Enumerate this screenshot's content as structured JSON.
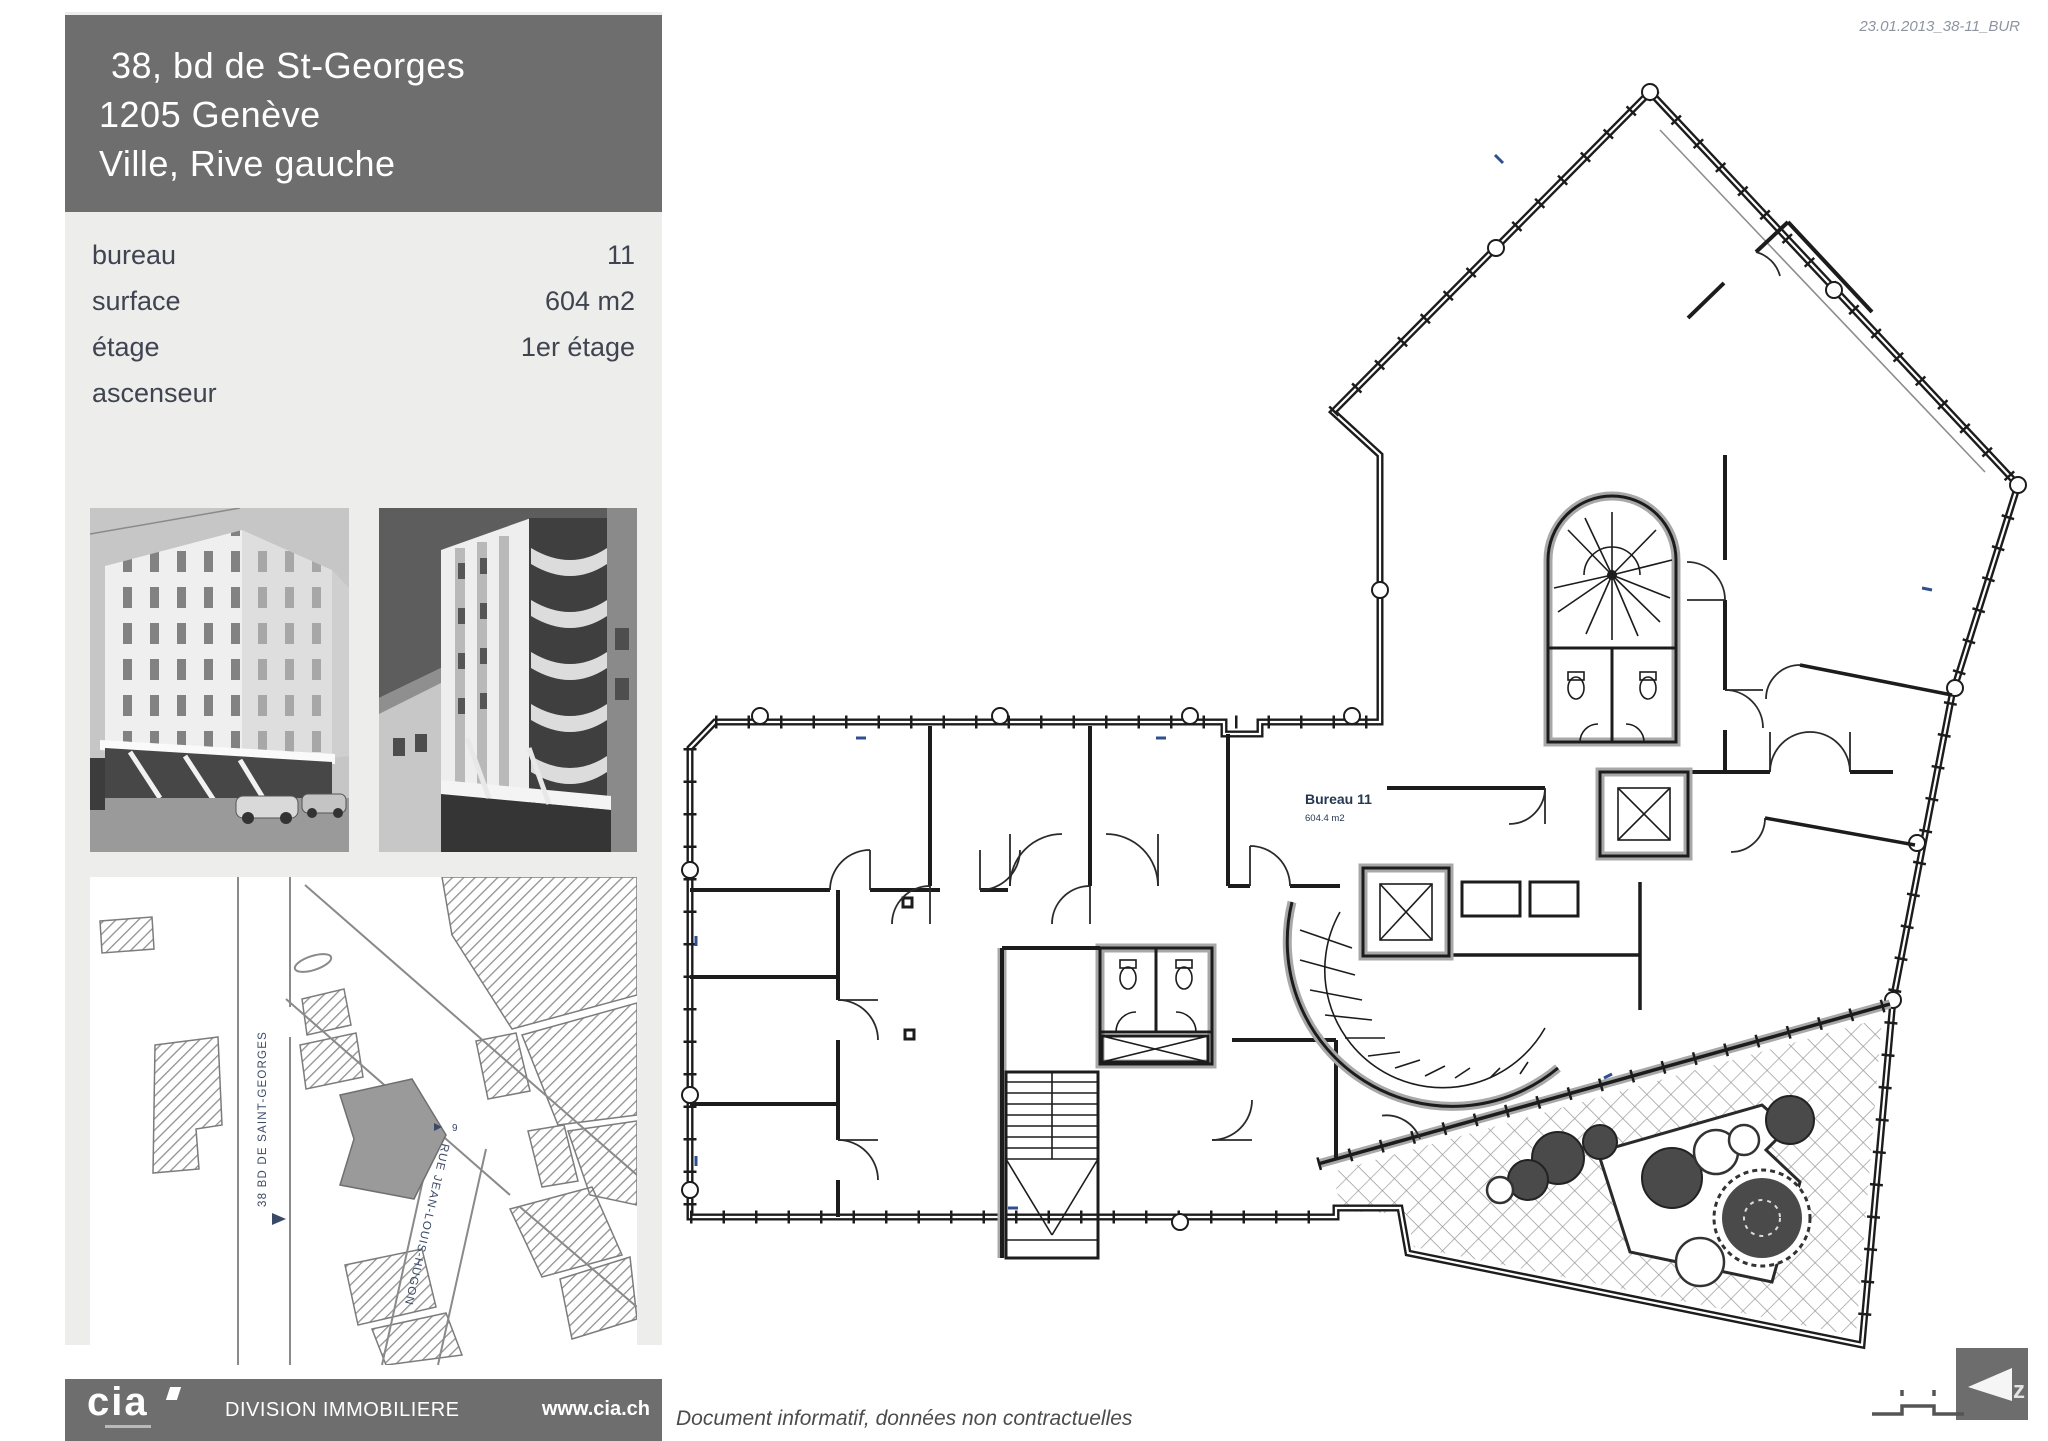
{
  "theme": {
    "header_gray": "#6e6e6e",
    "panel_gray": "#ededec",
    "line_color": "#1c1c1c"
  },
  "page": {
    "date_ref": "23.01.2013_38-11_BUR"
  },
  "sidebar": {
    "header": {
      "line1": "38, bd de St-Georges",
      "line2": "1205 Genève",
      "line3": "Ville, Rive gauche"
    },
    "details": [
      {
        "label": "bureau",
        "value": "11"
      },
      {
        "label": "surface",
        "value": "604 m2"
      },
      {
        "label": "étage",
        "value": "1er étage"
      },
      {
        "label": "ascenseur",
        "value": ""
      }
    ]
  },
  "map": {
    "street1": "38  BD DE SAINT-GEORGES",
    "street2": "RUE JEAN-LOUIS-HUGON",
    "house_number": "9"
  },
  "plan": {
    "room_label": "Bureau 11",
    "room_area": "604.4 m2",
    "north_letter": "z"
  },
  "footer": {
    "logo": "cia",
    "division": "DIVISION IMMOBILIERE",
    "website": "www.cia.ch",
    "disclaimer": "Document informatif, données non contractuelles"
  }
}
